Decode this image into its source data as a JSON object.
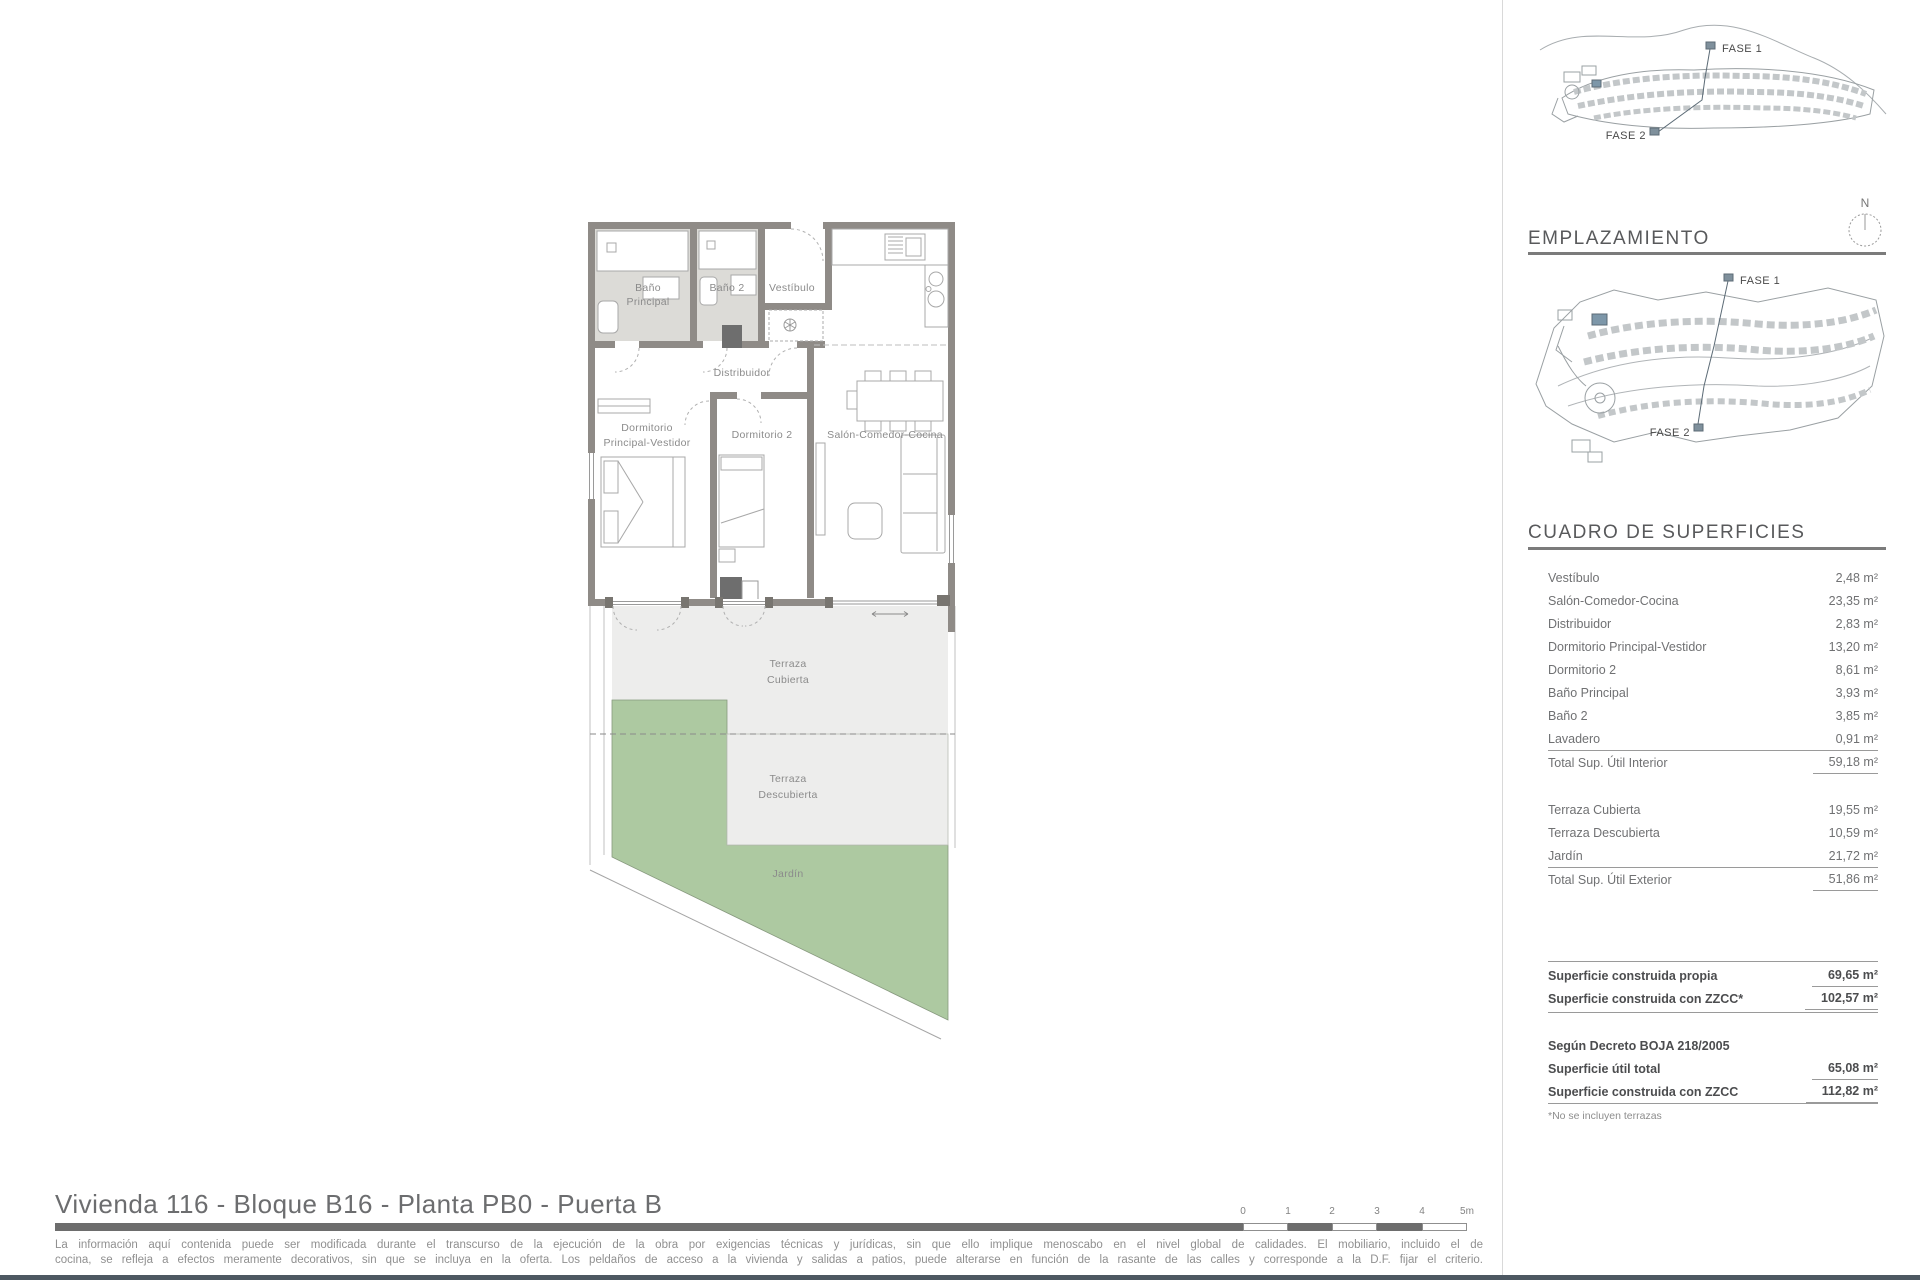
{
  "floor_plan": {
    "labels": {
      "bano_principal_1": "Baño",
      "bano_principal_2": "Principal",
      "bano2": "Baño 2",
      "vestibulo": "Vestíbulo",
      "distribuidor": "Distribuidor",
      "dorm_principal_1": "Dormitorio",
      "dorm_principal_2": "Principal-Vestidor",
      "dormitorio2": "Dormitorio 2",
      "salon": "Salón-Comedor-Cocina",
      "terraza_cubierta_1": "Terraza",
      "terraza_cubierta_2": "Cubierta",
      "terraza_descubierta_1": "Terraza",
      "terraza_descubierta_2": "Descubierta",
      "jardin": "Jardín"
    },
    "colors": {
      "garden": "#adc9a1",
      "terrace": "#ededec",
      "wall": "#8f8b87",
      "bath_floor": "#dcdbd7",
      "highlight_block": "#7d97a9"
    }
  },
  "sidebar": {
    "map_top": {
      "fase1": "FASE 1",
      "fase2": "FASE 2"
    },
    "emplazamiento_title": "EMPLAZAMIENTO",
    "compass_n": "N",
    "map_plan": {
      "fase1": "FASE 1",
      "fase2": "FASE 2"
    },
    "surfaces": {
      "title": "CUADRO DE SUPERFICIES",
      "interior_rows": [
        {
          "label": "Vestíbulo",
          "value": "2,48 m²"
        },
        {
          "label": "Salón-Comedor-Cocina",
          "value": "23,35 m²"
        },
        {
          "label": "Distribuidor",
          "value": "2,83 m²"
        },
        {
          "label": "Dormitorio Principal-Vestidor",
          "value": "13,20 m²"
        },
        {
          "label": "Dormitorio 2",
          "value": "8,61 m²"
        },
        {
          "label": "Baño Principal",
          "value": "3,93 m²"
        },
        {
          "label": "Baño 2",
          "value": "3,85 m²"
        },
        {
          "label": "Lavadero",
          "value": "0,91 m²"
        }
      ],
      "interior_total": {
        "label": "Total Sup. Útil Interior",
        "value": "59,18 m²"
      },
      "exterior_rows": [
        {
          "label": "Terraza Cubierta",
          "value": "19,55 m²"
        },
        {
          "label": "Terraza Descubierta",
          "value": "10,59 m²"
        },
        {
          "label": "Jardín",
          "value": "21,72 m²"
        }
      ],
      "exterior_total": {
        "label": "Total Sup. Útil Exterior",
        "value": "51,86 m²"
      },
      "built_rows": [
        {
          "label": "Superficie construida propia",
          "value": "69,65 m²"
        },
        {
          "label": "Superficie construida con ZZCC*",
          "value": "102,57 m²"
        }
      ],
      "decree_heading": "Según Decreto BOJA 218/2005",
      "decree_rows": [
        {
          "label": "Superficie útil total",
          "value": "65,08 m²"
        },
        {
          "label": "Superficie construida con ZZCC",
          "value": "112,82 m²"
        }
      ],
      "footnote": "*No se incluyen terrazas"
    }
  },
  "footer": {
    "title": "Vivienda 116 - Bloque B16 - Planta PB0 - Puerta B",
    "disclaimer_line1": "La información aquí contenida puede ser modificada durante el transcurso de la ejecución de la obra por exigencias técnicas y jurídicas, sin que ello implique menoscabo en el nivel global de calidades. El mobiliario, incluido el de",
    "disclaimer_line2": "cocina, se refleja a efectos meramente decorativos, sin que se incluya en la oferta. Los peldaños de acceso a la vivienda y salidas a patios, puede alterarse en función de la rasante de las calles y corresponde a la D.F. fijar el criterio.",
    "scale_labels": [
      "0",
      "1",
      "2",
      "3",
      "4",
      "5m"
    ]
  }
}
